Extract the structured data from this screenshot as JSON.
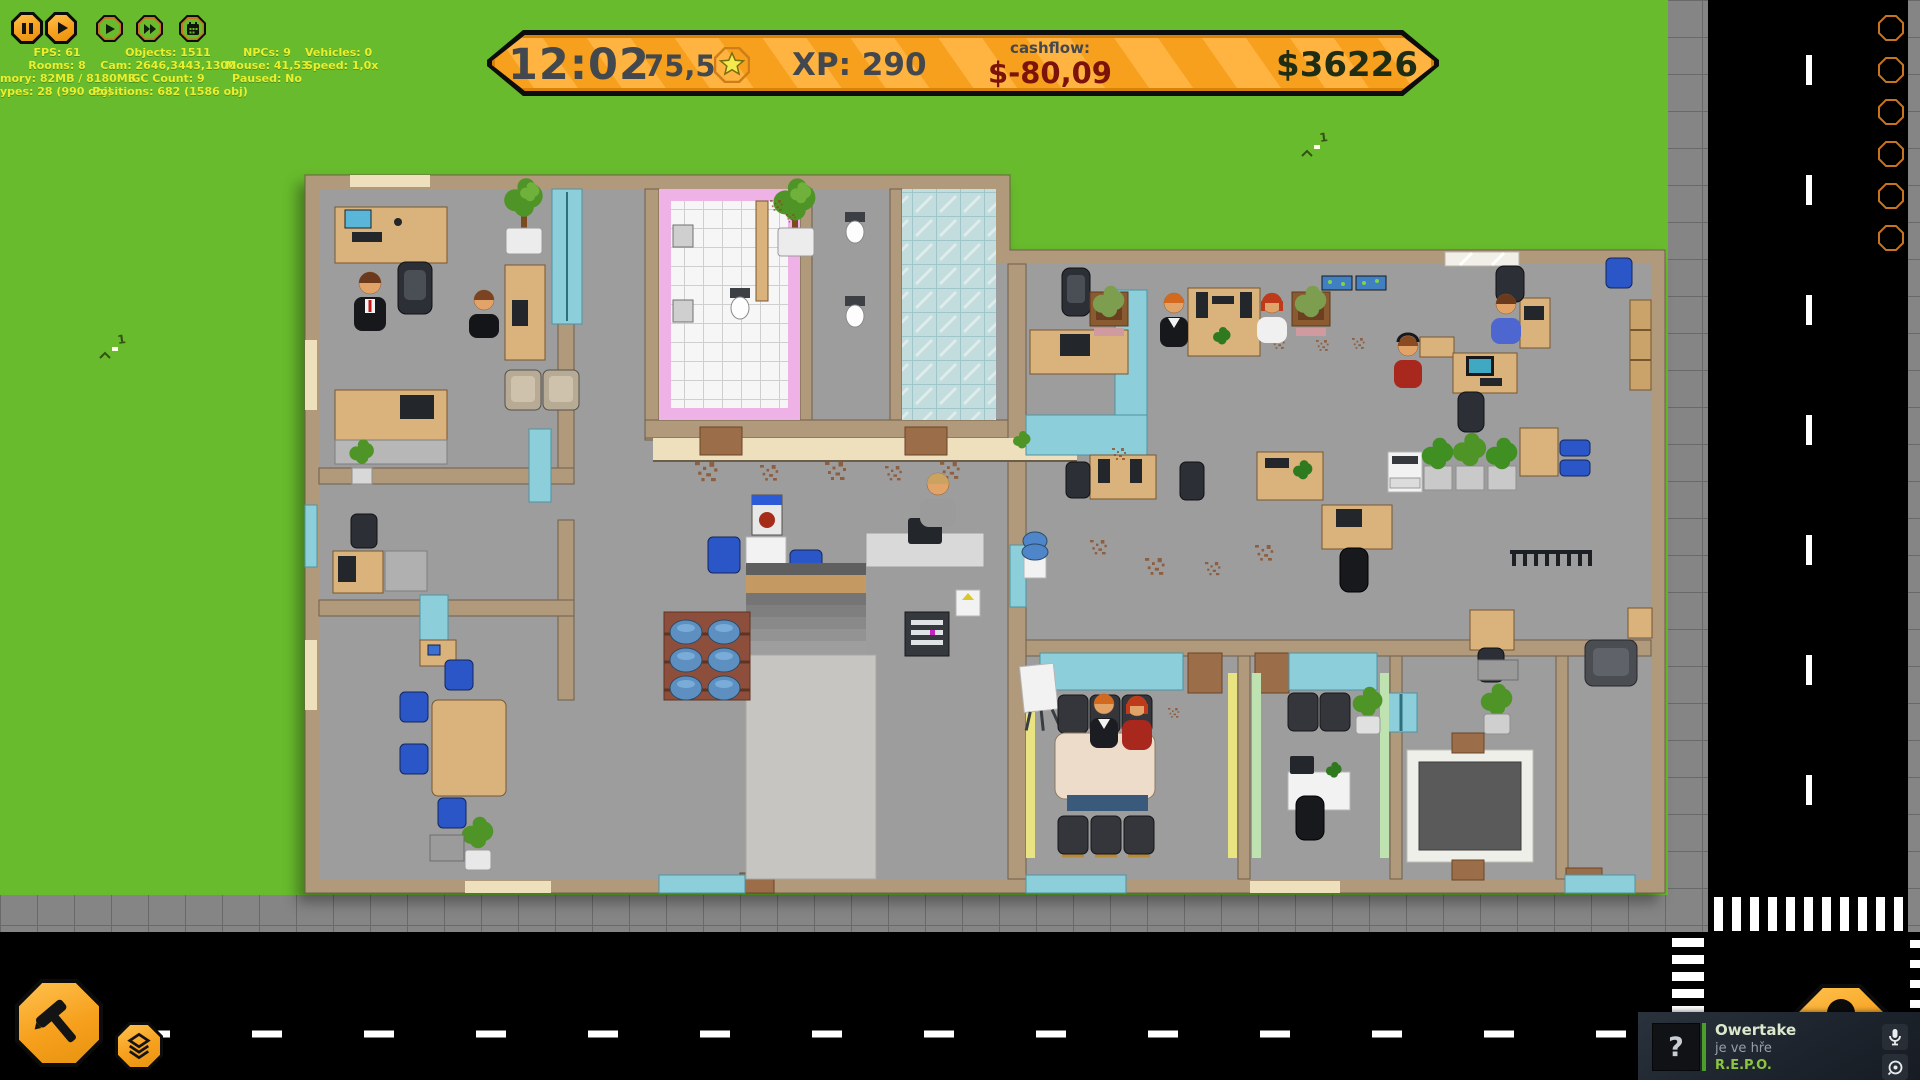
{
  "hud": {
    "time": "12:02",
    "rating": "75,5",
    "xp": "XP: 290",
    "cashflow_label": "cashflow:",
    "cashflow_value": "$-80,09",
    "balance": "$36226",
    "colors": {
      "banner_orange": "#f6a01d",
      "banner_stripe": "#ffb340",
      "text_dark": "#43474e",
      "cashflow_red": "#7c130b",
      "balance_dark": "#1e2d13"
    }
  },
  "debug": {
    "fps": "FPS: 61",
    "rooms": "Rooms: 8",
    "memory": "mory: 82MB / 8180MB",
    "types": "ypes: 28 (990 obj)",
    "objects": "Objects: 1511",
    "cam": "Cam: 2646,3443,1300",
    "gc": "GC Count: 9",
    "positions": "Positions: 682 (1586 obj)",
    "npcs": "NPCs: 9",
    "mouse": "Mouse: 41,53",
    "paused": "Paused: No",
    "vehicles": "Vehicles: 0",
    "speed": "Speed: 1,0x"
  },
  "controls": {
    "pause_icon": "pause-icon",
    "play_icon": "play-icon",
    "ff1_icon": "fast-forward-icon",
    "ff2_icon": "fast-forward-2-icon",
    "calendar_icon": "calendar-icon"
  },
  "toolbar": {
    "build_icon": "hammer-icon",
    "layers_icon": "layers-icon",
    "phone_icon": "phone-icon"
  },
  "world": {
    "grass_color": "#68bb2d",
    "marker_label": "1"
  },
  "notification": {
    "avatar_text": "?",
    "name": "Owertake",
    "status": "je ve hře",
    "game": "R.E.P.O.",
    "accent_green": "#8cc63f",
    "mic_icon": "microphone-icon",
    "voice_icon": "voice-chat-icon"
  }
}
